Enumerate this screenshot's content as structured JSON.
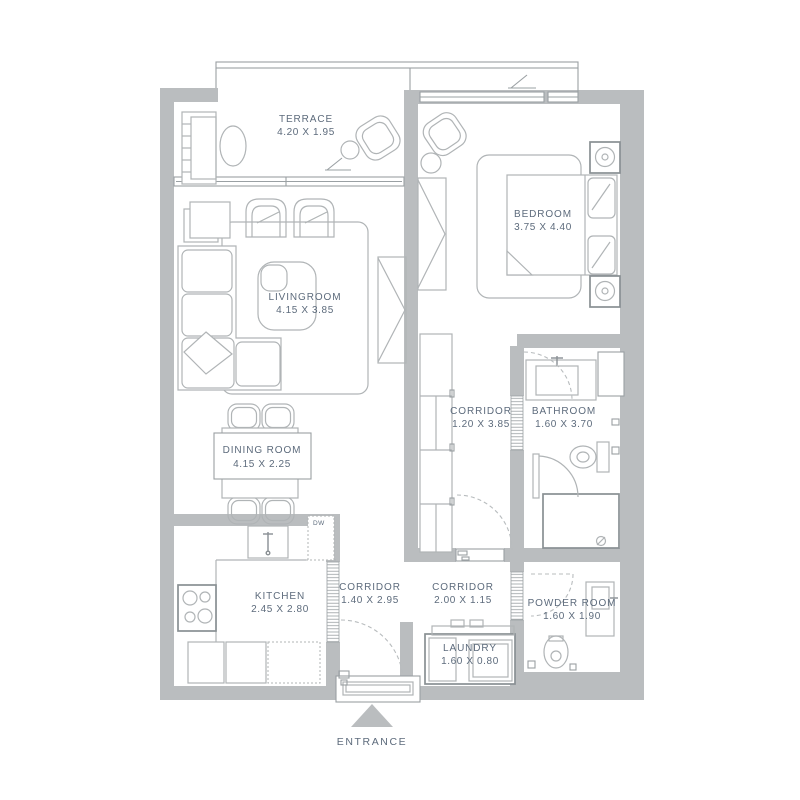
{
  "colors": {
    "wall": "#babdbf",
    "line": "#9aa0a3",
    "furniture": "#b0b4b6",
    "fixture": "#898f93",
    "dashed": "#b8bcbe",
    "text": "#5d6b7c",
    "bg": "#ffffff"
  },
  "rooms": [
    {
      "id": "terrace",
      "name": "TERRACE",
      "dims": "4.20 X 1.95"
    },
    {
      "id": "bedroom",
      "name": "BEDROOM",
      "dims": "3.75 X 4.40"
    },
    {
      "id": "livingroom",
      "name": "LIVINGROOM",
      "dims": "4.15 X 3.85"
    },
    {
      "id": "dining-room",
      "name": "DINING ROOM",
      "dims": "4.15 X 2.25"
    },
    {
      "id": "corridor-main",
      "name": "CORRIDOR",
      "dims": "1.20 X 3.85"
    },
    {
      "id": "bathroom",
      "name": "BATHROOM",
      "dims": "1.60 X 3.70"
    },
    {
      "id": "kitchen",
      "name": "KITCHEN",
      "dims": "2.45 X 2.80"
    },
    {
      "id": "corridor-entry",
      "name": "CORRIDOR",
      "dims": "1.40 X 2.95"
    },
    {
      "id": "corridor-hall",
      "name": "CORRIDOR",
      "dims": "2.00 X 1.15"
    },
    {
      "id": "powder-room",
      "name": "POWDER ROOM",
      "dims": "1.60 X 1.90"
    },
    {
      "id": "laundry",
      "name": "LAUNDRY",
      "dims": "1.60 X 0.80"
    }
  ],
  "annotations": {
    "entrance": "ENTRANCE",
    "dishwasher": "DW"
  }
}
